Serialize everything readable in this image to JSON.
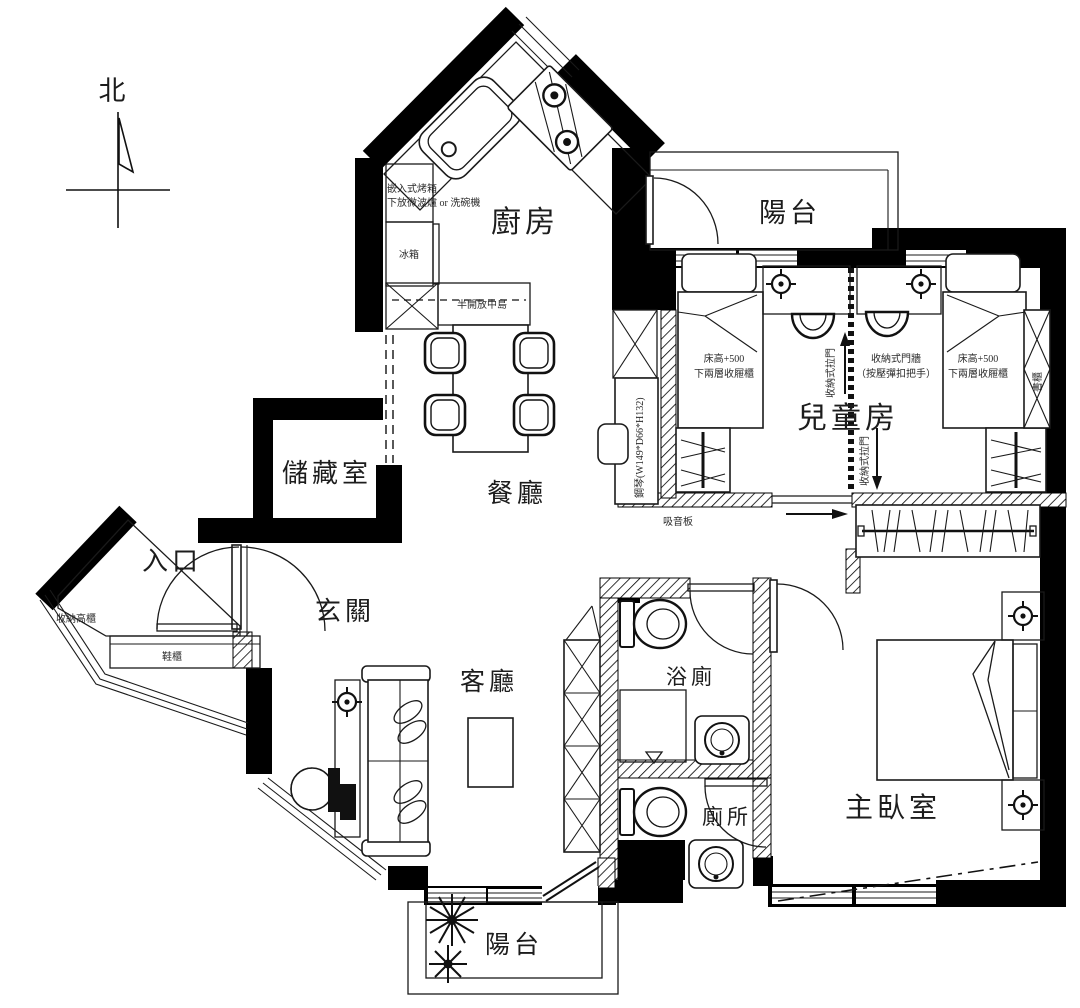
{
  "meta": {
    "type": "apartment-floor-plan",
    "background": "#ffffff",
    "wall_color": "#000000",
    "line_color": "#1a1a1a"
  },
  "compass": {
    "north_label": "北"
  },
  "rooms": {
    "kitchen": "廚房",
    "balcony_top": "陽台",
    "kids_room": "兒童房",
    "storage_room": "儲藏室",
    "dining_room": "餐廳",
    "entrance": "入口",
    "foyer": "玄關",
    "living_room": "客廳",
    "bathroom": "浴廁",
    "toilet": "廁所",
    "master_bedroom": "主臥室",
    "balcony_bottom": "陽台"
  },
  "annotations": {
    "oven_line1": "嵌入式烤箱",
    "oven_line2": "下放微波爐 or 洗碗機",
    "fridge": "冰箱",
    "island": "半開放中島",
    "bed_height_note": "床高+500",
    "bed_drawer_note": "下兩層收屜櫃",
    "sliding_door": "收納式拉門",
    "door_wall_line1": "收納式門牆",
    "door_wall_line2": "（按壓彈扣把手）",
    "piano": "鋼琴(W149*D66*H132)",
    "bookcase": "書櫃",
    "sound_board": "吸音板",
    "tall_cabinet": "收納高櫃",
    "shoe_cabinet": "鞋櫃"
  }
}
